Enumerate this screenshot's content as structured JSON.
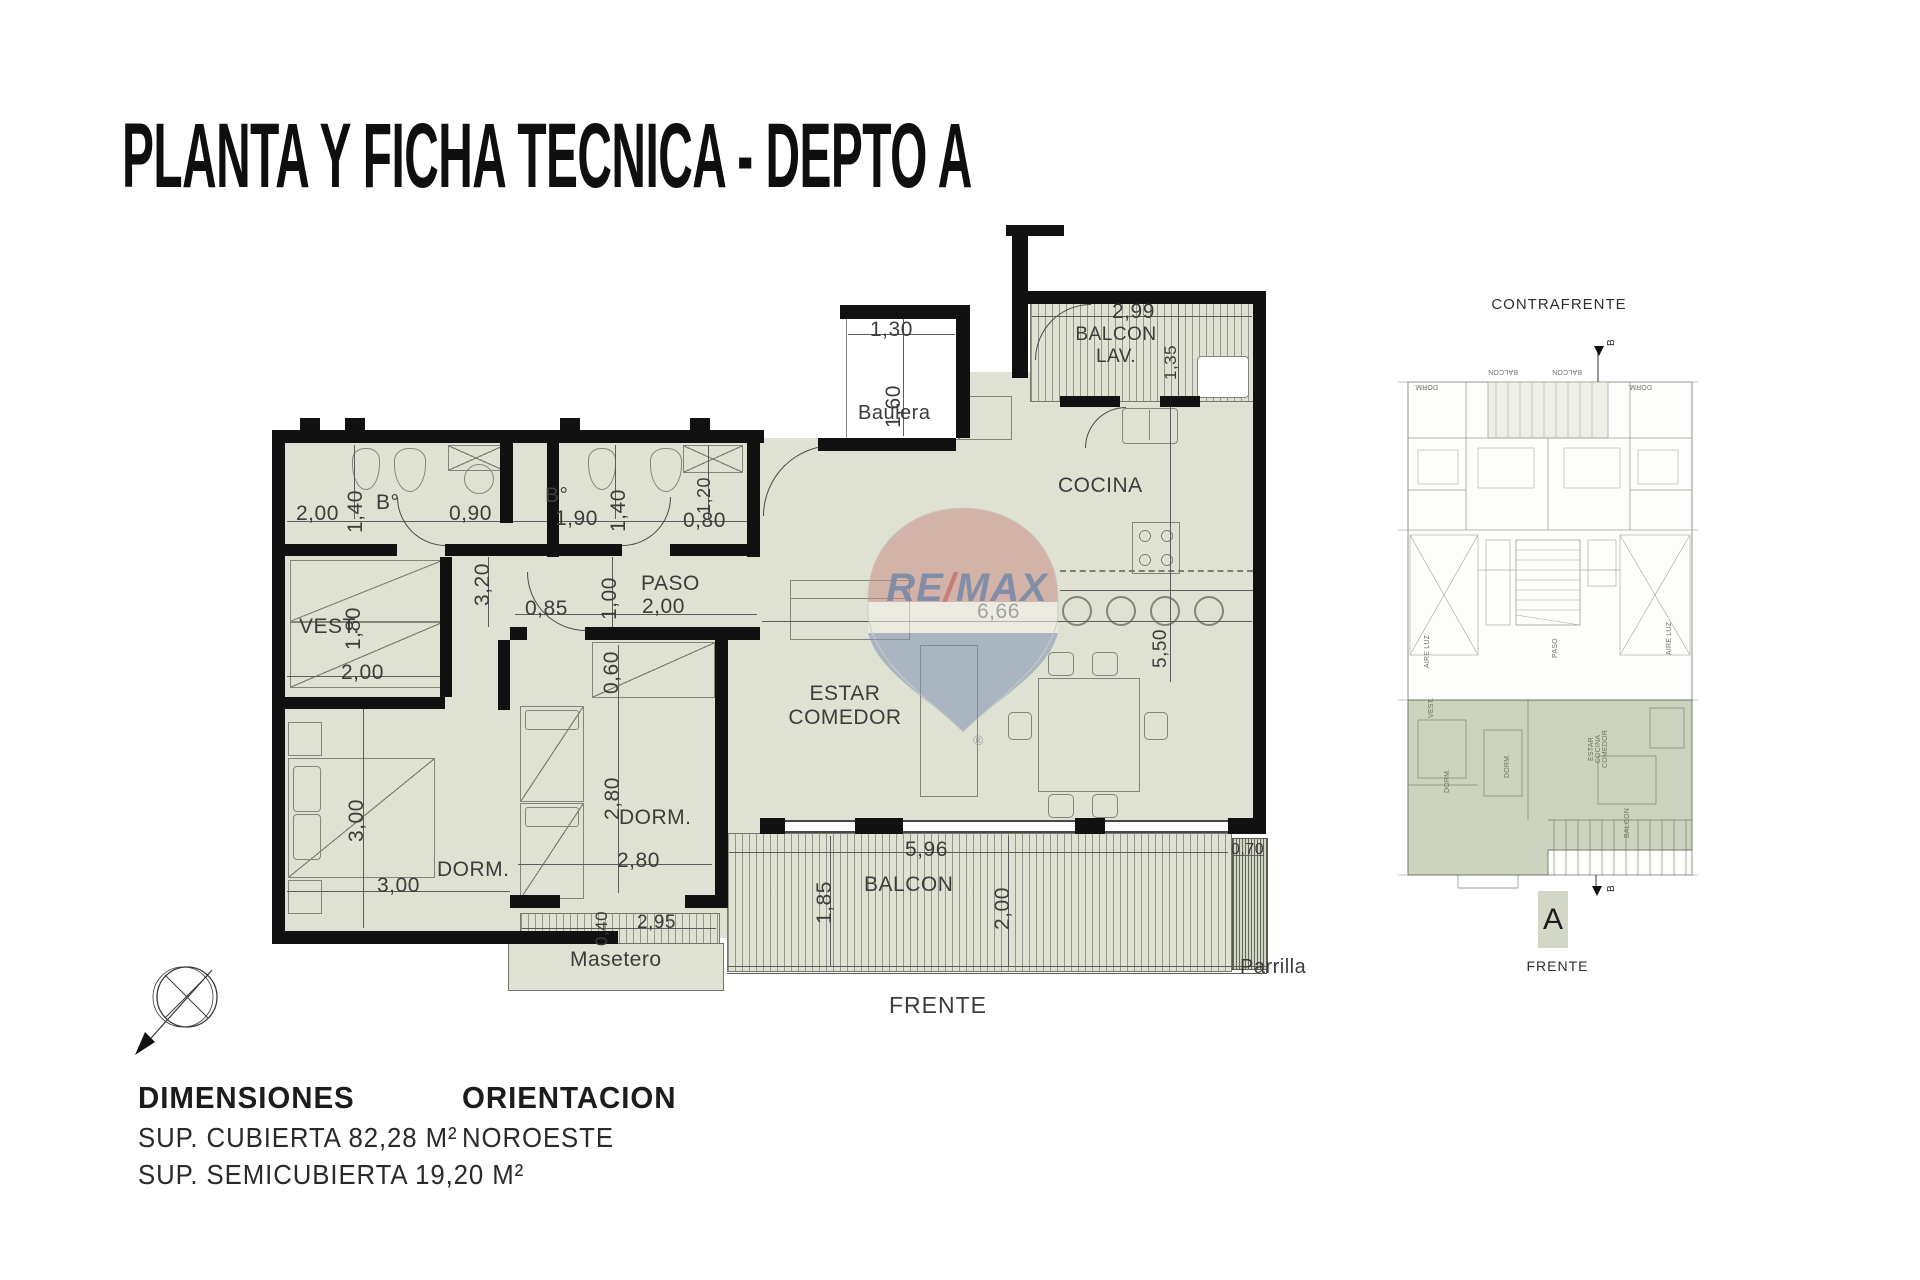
{
  "title": "PLANTA Y FICHA TECNICA - DEPTO A",
  "colors": {
    "room_fill": "#dfe2d2",
    "wall": "#111111",
    "unit_fill": "#cdd4bd",
    "remax_red": "#c4736b",
    "remax_blue": "#6f84a8"
  },
  "plan": {
    "rooms": {
      "bath1": "B°",
      "bath2": "B°",
      "vest": "VEST.",
      "dorm1": "DORM.",
      "dorm2": "DORM.",
      "paso": "PASO",
      "cocina": "COCINA",
      "estar": "ESTAR\nCOMEDOR",
      "balcon": "BALCON",
      "balcon_lav": "BALCON\nLAV.",
      "baulera": "Baulera",
      "masetero": "Masetero",
      "parrilla": "Parrilla",
      "frente": "FRENTE"
    },
    "dims": {
      "baulera_w": "1,30",
      "baulera_h": "1,60",
      "lav_w": "2,99",
      "lav_h": "1,35",
      "bath1_w": "2,00",
      "bath1_h": "1,40",
      "bath1_door": "0,90",
      "bath2_w": "1,90",
      "bath2_h": "1,40",
      "bath2_side": "1,20",
      "bath2_door": "0,80",
      "pasillo_h": "3,20",
      "vest_h": "1,80",
      "vest_w": "2,00",
      "paso_a": "0,85",
      "paso_b": "1,00",
      "paso_w": "2,00",
      "dorm1_h": "3,00",
      "dorm1_w": "3,00",
      "dorm2_closet": "0,60",
      "dorm2_h": "2,80",
      "dorm2_w": "2,80",
      "masetero_h": "0,40",
      "masetero_w": "2,95",
      "estar_w": "6,66",
      "cocina_h": "5,50",
      "balcon_w": "5,96",
      "balcon_h": "1,85",
      "balcon_h2": "2,00",
      "parrilla_w": "0,70"
    }
  },
  "watermark": {
    "brand": "RE/MAX",
    "slash": "/",
    "brand_left": "RE",
    "brand_right": "MAX",
    "registered": "®"
  },
  "mini_plan": {
    "top_label": "CONTRAFRENTE",
    "bottom_label": "FRENTE",
    "unit_marker": "A",
    "section_marker": "B",
    "tiny_labels": [
      "AIRE LUZ",
      "AIRE LUZ",
      "PASO",
      "ESTAR\nCOCINA\nCOMEDOR",
      "DORM.",
      "DORM.",
      "VEST.",
      "BALCON",
      "DORM.",
      "DORM.",
      "BALCON",
      "BALCON"
    ]
  },
  "footer": {
    "dimensions_heading": "DIMENSIONES",
    "sup_cubierta": "SUP. CUBIERTA 82,28 M²",
    "sup_semicubierta": "SUP. SEMICUBIERTA 19,20 M²",
    "orientation_heading": "ORIENTACION",
    "orientation_value": "NOROESTE"
  }
}
